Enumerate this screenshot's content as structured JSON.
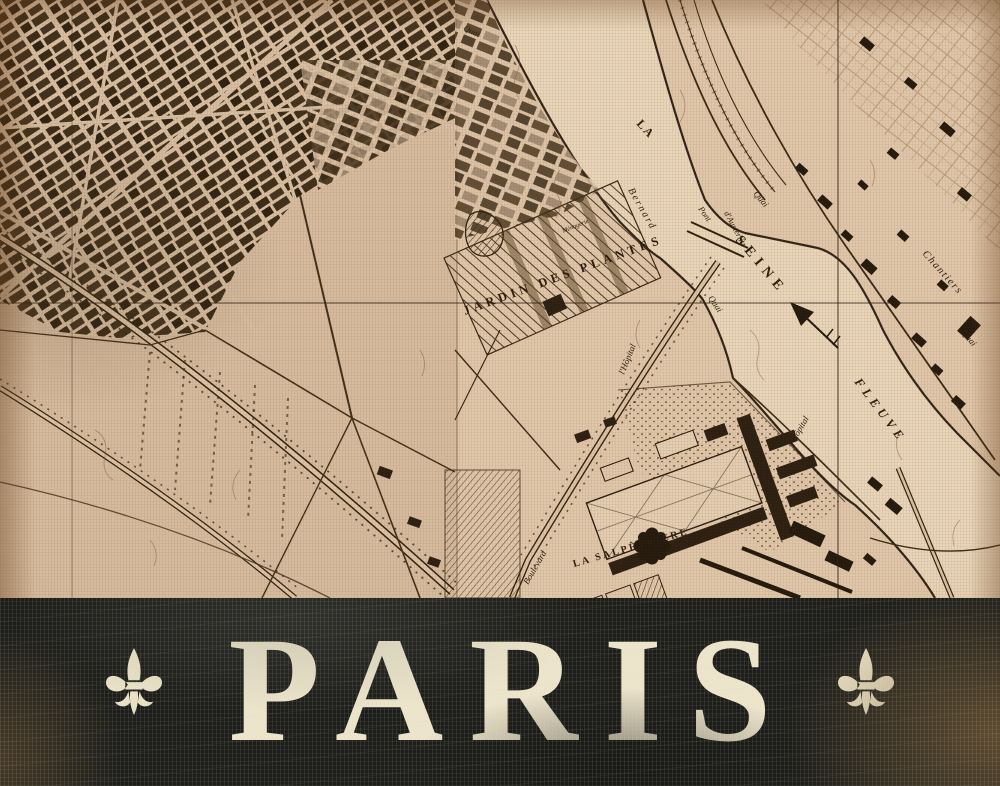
{
  "poster": {
    "banner": {
      "title": "PARIS",
      "background_color": "#1d1e1b",
      "text_color": "#ece4cb",
      "left_icon": "fleur-de-lis",
      "right_icon": "fleur-de-lis"
    },
    "map": {
      "colors": {
        "parchment_left": "#d6bb9e",
        "parchment_right": "#e1c7aa",
        "river": "#e9d5b9",
        "ink": "#30220f",
        "crackle": "#7d5434"
      },
      "labels": {
        "jardin_des_plantes": "JARDIN DES PLANTES",
        "menagerie": "Ménagerie",
        "la": "LA",
        "seine": "SEINE",
        "fleuve": "FLEUVE",
        "bernard": "Bernard",
        "pont": "Pont",
        "austerlitz": "d'Austerlitz",
        "quai": "Quai",
        "chantiers": "Chantiers",
        "salpetriere": "LA SALPÊTRIÈRE",
        "boulevard": "Boulevard",
        "hopital": "l'Hôpital"
      }
    }
  }
}
